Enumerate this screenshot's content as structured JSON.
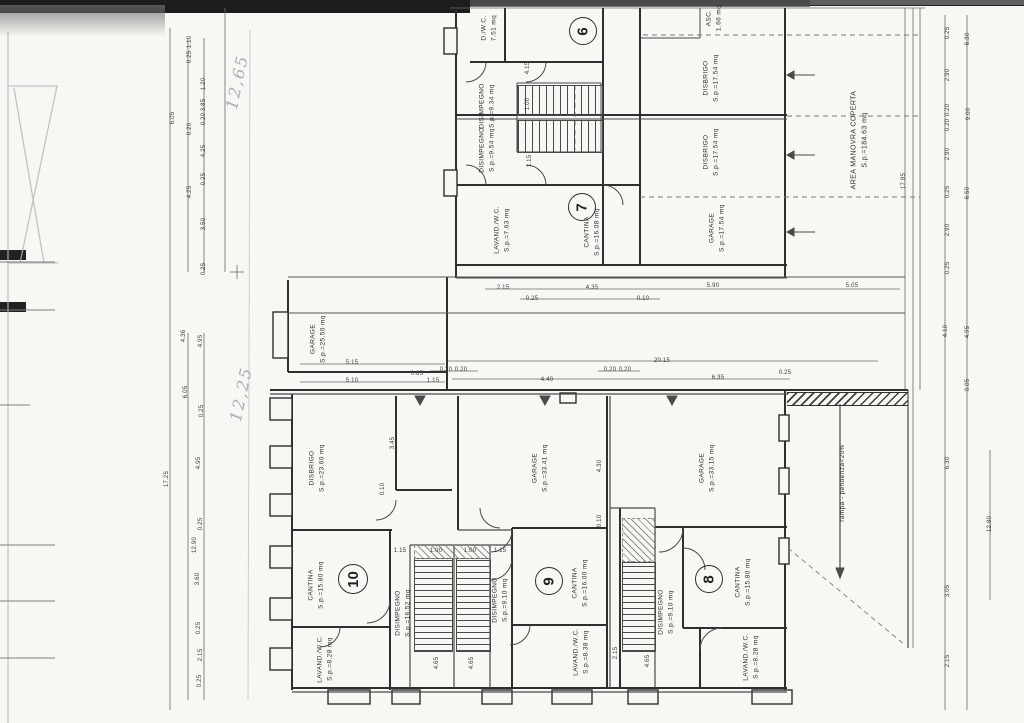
{
  "document": {
    "type": "Scanned architectural floor plan - garage / cellar level",
    "language": "Italian"
  },
  "units": [
    {
      "number": "6"
    },
    {
      "number": "7"
    },
    {
      "number": "8"
    },
    {
      "number": "9"
    },
    {
      "number": "10"
    }
  ],
  "rooms": {
    "u6_wc": "D./W.C.\n7.51 mq",
    "u6_disimpegno": "DISIMPEGNO\nS.p.=9.34 mq",
    "u7_disimpegno": "DISIMPEGNO\nS.p.=9.54 mq",
    "asc": "ASC.\n1.66 mq",
    "disbrigo_upper": "DISBRIGO\nS.p.=17.54 mq",
    "disbrigo_lower": "DISBRIGO\nS.p.=17.54 mq",
    "u7_cantina": "CANTINA\nS.p.=16.08 mq",
    "u7_lavand": "LAVAND./W.C.\nS.p.=7.63 mq",
    "u7_garage": "GARAGE\nS.p.=17.54 mq",
    "garage_centrale": "GARAGE\nS.p.=25.50 mq",
    "u10_disbrigo": "DISBRIGO\nS.p.=23.60 mq",
    "u10_cantina": "CANTINA\nS.p.=15.80 mq",
    "u10_lavand": "LAVAND./W.C.\nS.p.=8.28 mq",
    "u10_disimpegno": "DISIMPEGNO\nS.p.=16.52 mq",
    "u9_garage": "GARAGE\nS.p.=33.41 mq",
    "u9_cantina": "CANTINA\nS.p.=16.00 mq",
    "u9_lavand": "LAVAND./W.C.\nS.p.=8.38 mq",
    "u9_disimpegno": "DISIMPEGNO\nS.p.=9.10 mq",
    "u8_garage": "GARAGE\nS.p.=33.15 mq",
    "u8_cantina": "CANTINA\nS.p.=15.80 mq",
    "u8_lavand": "LAVAND./W.C.\nS.p.=8.28 mq",
    "u8_disimpegno": "DISIMPEGNO\nS.p.=9.10 mq",
    "area_manovra": "AREA MANOVRA COPERTA\nS.p.=184.63 mq",
    "rampa": "rampa - pendenza<20%"
  },
  "handwritten": {
    "note_top": "12,65",
    "note_bottom": "12,25"
  },
  "dimensions": [
    {
      "t": "1.10",
      "x": 190,
      "y": 42,
      "r": 1
    },
    {
      "t": "0.25",
      "x": 190,
      "y": 57,
      "r": 1
    },
    {
      "t": "1.20",
      "x": 204,
      "y": 84,
      "r": 1
    },
    {
      "t": "3.85",
      "x": 204,
      "y": 105,
      "r": 1
    },
    {
      "t": "0.20",
      "x": 204,
      "y": 119,
      "r": 1
    },
    {
      "t": "0.20",
      "x": 190,
      "y": 129,
      "r": 1
    },
    {
      "t": "4.25",
      "x": 204,
      "y": 151,
      "r": 1
    },
    {
      "t": "6.05",
      "x": 173,
      "y": 118,
      "r": 1
    },
    {
      "t": "0.25",
      "x": 204,
      "y": 179,
      "r": 1
    },
    {
      "t": "4.25",
      "x": 190,
      "y": 192,
      "r": 1
    },
    {
      "t": "3.50",
      "x": 204,
      "y": 224,
      "r": 1
    },
    {
      "t": "0.25",
      "x": 204,
      "y": 269,
      "r": 1
    },
    {
      "t": "4.36",
      "x": 184,
      "y": 336,
      "r": 1
    },
    {
      "t": "4.95",
      "x": 201,
      "y": 341,
      "r": 1
    },
    {
      "t": "6.05",
      "x": 186,
      "y": 392,
      "r": 1
    },
    {
      "t": "0.25",
      "x": 202,
      "y": 411,
      "r": 1
    },
    {
      "t": "4.95",
      "x": 199,
      "y": 463,
      "r": 1
    },
    {
      "t": "17.25",
      "x": 167,
      "y": 479,
      "r": 1
    },
    {
      "t": "0.25",
      "x": 201,
      "y": 524,
      "r": 1
    },
    {
      "t": "12.90",
      "x": 195,
      "y": 545,
      "r": 1
    },
    {
      "t": "3.60",
      "x": 198,
      "y": 579,
      "r": 1
    },
    {
      "t": "0.25",
      "x": 199,
      "y": 628,
      "r": 1
    },
    {
      "t": "2.15",
      "x": 201,
      "y": 655,
      "r": 1
    },
    {
      "t": "0.25",
      "x": 200,
      "y": 681,
      "r": 1
    },
    {
      "t": "0.25",
      "x": 948,
      "y": 33,
      "r": 1
    },
    {
      "t": "6.30",
      "x": 968,
      "y": 39,
      "r": 1
    },
    {
      "t": "2.90",
      "x": 948,
      "y": 75,
      "r": 1
    },
    {
      "t": "0.20",
      "x": 948,
      "y": 110,
      "r": 1
    },
    {
      "t": "0.20",
      "x": 948,
      "y": 125,
      "r": 1
    },
    {
      "t": "9.00",
      "x": 969,
      "y": 114,
      "r": 1
    },
    {
      "t": "2.90",
      "x": 948,
      "y": 154,
      "r": 1
    },
    {
      "t": "0.25",
      "x": 948,
      "y": 192,
      "r": 1
    },
    {
      "t": "6.50",
      "x": 968,
      "y": 193,
      "r": 1
    },
    {
      "t": "2.90",
      "x": 948,
      "y": 230,
      "r": 1
    },
    {
      "t": "0.25",
      "x": 948,
      "y": 268,
      "r": 1
    },
    {
      "t": "4.10",
      "x": 946,
      "y": 331,
      "r": 1
    },
    {
      "t": "4.95",
      "x": 968,
      "y": 332,
      "r": 1
    },
    {
      "t": "0.05",
      "x": 968,
      "y": 385,
      "r": 1
    },
    {
      "t": "17.85",
      "x": 904,
      "y": 181,
      "r": 1
    },
    {
      "t": "6.30",
      "x": 948,
      "y": 463,
      "r": 1
    },
    {
      "t": "12.80",
      "x": 990,
      "y": 524,
      "r": 1
    },
    {
      "t": "3.05",
      "x": 948,
      "y": 591,
      "r": 1
    },
    {
      "t": "2.15",
      "x": 948,
      "y": 661,
      "r": 1
    },
    {
      "t": "2.15",
      "x": 503,
      "y": 288
    },
    {
      "t": "0.25",
      "x": 532,
      "y": 299
    },
    {
      "t": "4.35",
      "x": 592,
      "y": 288
    },
    {
      "t": "0.10",
      "x": 643,
      "y": 299
    },
    {
      "t": "5.90",
      "x": 713,
      "y": 286
    },
    {
      "t": "5.05",
      "x": 852,
      "y": 286
    },
    {
      "t": "5.15",
      "x": 352,
      "y": 363
    },
    {
      "t": "5.10",
      "x": 352,
      "y": 381
    },
    {
      "t": "0.85",
      "x": 417,
      "y": 374
    },
    {
      "t": "0.20",
      "x": 446,
      "y": 370
    },
    {
      "t": "0.20",
      "x": 461,
      "y": 370
    },
    {
      "t": "1.15",
      "x": 433,
      "y": 381
    },
    {
      "t": "4.40",
      "x": 547,
      "y": 380
    },
    {
      "t": "20.15",
      "x": 662,
      "y": 361
    },
    {
      "t": "0.20",
      "x": 610,
      "y": 370
    },
    {
      "t": "0.20",
      "x": 625,
      "y": 370
    },
    {
      "t": "6.35",
      "x": 718,
      "y": 378
    },
    {
      "t": "0.25",
      "x": 785,
      "y": 373
    },
    {
      "t": "4.15",
      "x": 528,
      "y": 68,
      "r": 1
    },
    {
      "t": "1.00",
      "x": 528,
      "y": 104,
      "r": 1
    },
    {
      "t": "1.15",
      "x": 530,
      "y": 161,
      "r": 1
    },
    {
      "t": "3.45",
      "x": 393,
      "y": 443,
      "r": 1
    },
    {
      "t": "0.10",
      "x": 383,
      "y": 489,
      "r": 1
    },
    {
      "t": "1.15",
      "x": 400,
      "y": 551
    },
    {
      "t": "1.00",
      "x": 436,
      "y": 551
    },
    {
      "t": "1.00",
      "x": 470,
      "y": 551
    },
    {
      "t": "1.15",
      "x": 500,
      "y": 551
    },
    {
      "t": "4.65",
      "x": 437,
      "y": 663,
      "r": 1
    },
    {
      "t": "4.65",
      "x": 472,
      "y": 663,
      "r": 1
    },
    {
      "t": "4.65",
      "x": 648,
      "y": 661,
      "r": 1
    },
    {
      "t": "2.15",
      "x": 616,
      "y": 653,
      "r": 1
    },
    {
      "t": "4.30",
      "x": 600,
      "y": 466,
      "r": 1
    },
    {
      "t": "0.10",
      "x": 600,
      "y": 521,
      "r": 1
    }
  ]
}
